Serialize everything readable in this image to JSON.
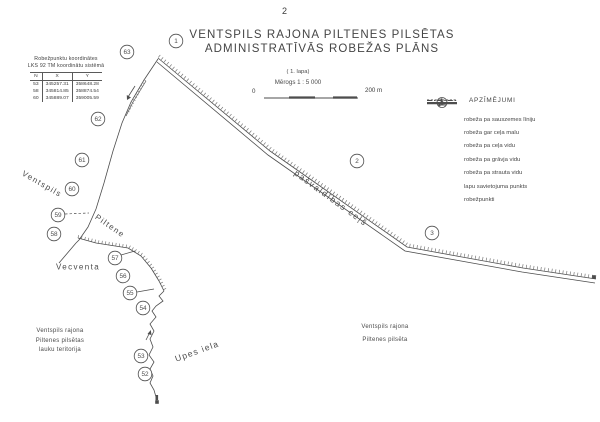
{
  "page": {
    "number": "2",
    "title_line1": "VENTSPILS RAJONA PILTENES PILSĒTAS",
    "title_line2": "ADMINISTRATĪVĀS ROBEŽAS PLĀNS",
    "sheet_note": "( 1. lapa)",
    "scale_label": "Mērogs 1 : 5 000",
    "scale_zero": "0",
    "scale_end": "200 m"
  },
  "coord_table": {
    "header_line1": "Robežpunktu koordinātes",
    "header_line2": "LKS 92 TM koordinātu sistēmā",
    "columns": [
      "N",
      "X",
      "Y"
    ],
    "rows": [
      [
        "53",
        "345257.31",
        "358648.28"
      ],
      [
        "58",
        "345814.85",
        "358874.54"
      ],
      [
        "60",
        "345889.07",
        "359005.59"
      ]
    ]
  },
  "legend": {
    "title": "APZĪMĒJUMI",
    "items": [
      {
        "symbol": "solid-line",
        "label": "robeža pa sauszemes līniju"
      },
      {
        "symbol": "dashed-over-solid",
        "label": "robeža gar ceļa malu"
      },
      {
        "symbol": "dash-dot-line",
        "label": "robeža pa ceļa vidu"
      },
      {
        "symbol": "dash-tick-line",
        "label": "robeža pa grāvja vidu"
      },
      {
        "symbol": "dash-arrow-line",
        "label": "robeža pa strauta vidu"
      },
      {
        "symbol": "dot",
        "label": "lapu savietojuma punkts"
      },
      {
        "symbol": "numbered-circle",
        "symbol_number": "1",
        "label": "robežpunkti"
      }
    ]
  },
  "map": {
    "boundary_points": [
      {
        "id": "1",
        "x": 176,
        "y": 41
      },
      {
        "id": "2",
        "x": 357,
        "y": 161
      },
      {
        "id": "3",
        "x": 432,
        "y": 233
      },
      {
        "id": "63",
        "x": 127,
        "y": 52
      },
      {
        "id": "62",
        "x": 98,
        "y": 119
      },
      {
        "id": "61",
        "x": 82,
        "y": 160
      },
      {
        "id": "60",
        "x": 72,
        "y": 189
      },
      {
        "id": "59",
        "x": 58,
        "y": 215
      },
      {
        "id": "58",
        "x": 54,
        "y": 234
      },
      {
        "id": "57",
        "x": 115,
        "y": 258
      },
      {
        "id": "56",
        "x": 123,
        "y": 276
      },
      {
        "id": "55",
        "x": 130,
        "y": 293
      },
      {
        "id": "54",
        "x": 143,
        "y": 308
      },
      {
        "id": "53",
        "x": 141,
        "y": 356
      },
      {
        "id": "52",
        "x": 145,
        "y": 374
      }
    ],
    "join_points": [
      {
        "x": 594,
        "y": 277
      },
      {
        "x": 157,
        "y": 402
      }
    ],
    "labels": [
      {
        "text": "Ventspils",
        "x": 42,
        "y": 184,
        "rotate": 30,
        "size": 8,
        "spacing": 1.4
      },
      {
        "text": "Piltene",
        "x": 110,
        "y": 226,
        "rotate": 35,
        "size": 8,
        "spacing": 1.4
      },
      {
        "text": "Vecventa",
        "x": 78,
        "y": 267,
        "rotate": 0,
        "size": 8,
        "spacing": 1.4
      },
      {
        "text": "pašvaldības ceļš",
        "x": 331,
        "y": 198,
        "rotate": 36,
        "size": 8.5,
        "spacing": 1.6
      },
      {
        "text": "Upes iela",
        "x": 197,
        "y": 351,
        "rotate": -20,
        "size": 8.5,
        "spacing": 1.2
      }
    ],
    "area_notes": [
      {
        "lines": [
          "Ventspils rajona",
          "Piltenes pilsētas",
          "lauku teritorija"
        ],
        "x": 60,
        "y": 327,
        "line_height": 9.5
      },
      {
        "lines": [
          "Ventspils rajona",
          "Piltenes pilsēta"
        ],
        "x": 385,
        "y": 321,
        "line_height": 13
      }
    ]
  },
  "colors": {
    "ink": "#4d4d4d",
    "tick": "#6e6e6e",
    "paper": "#ffffff"
  }
}
